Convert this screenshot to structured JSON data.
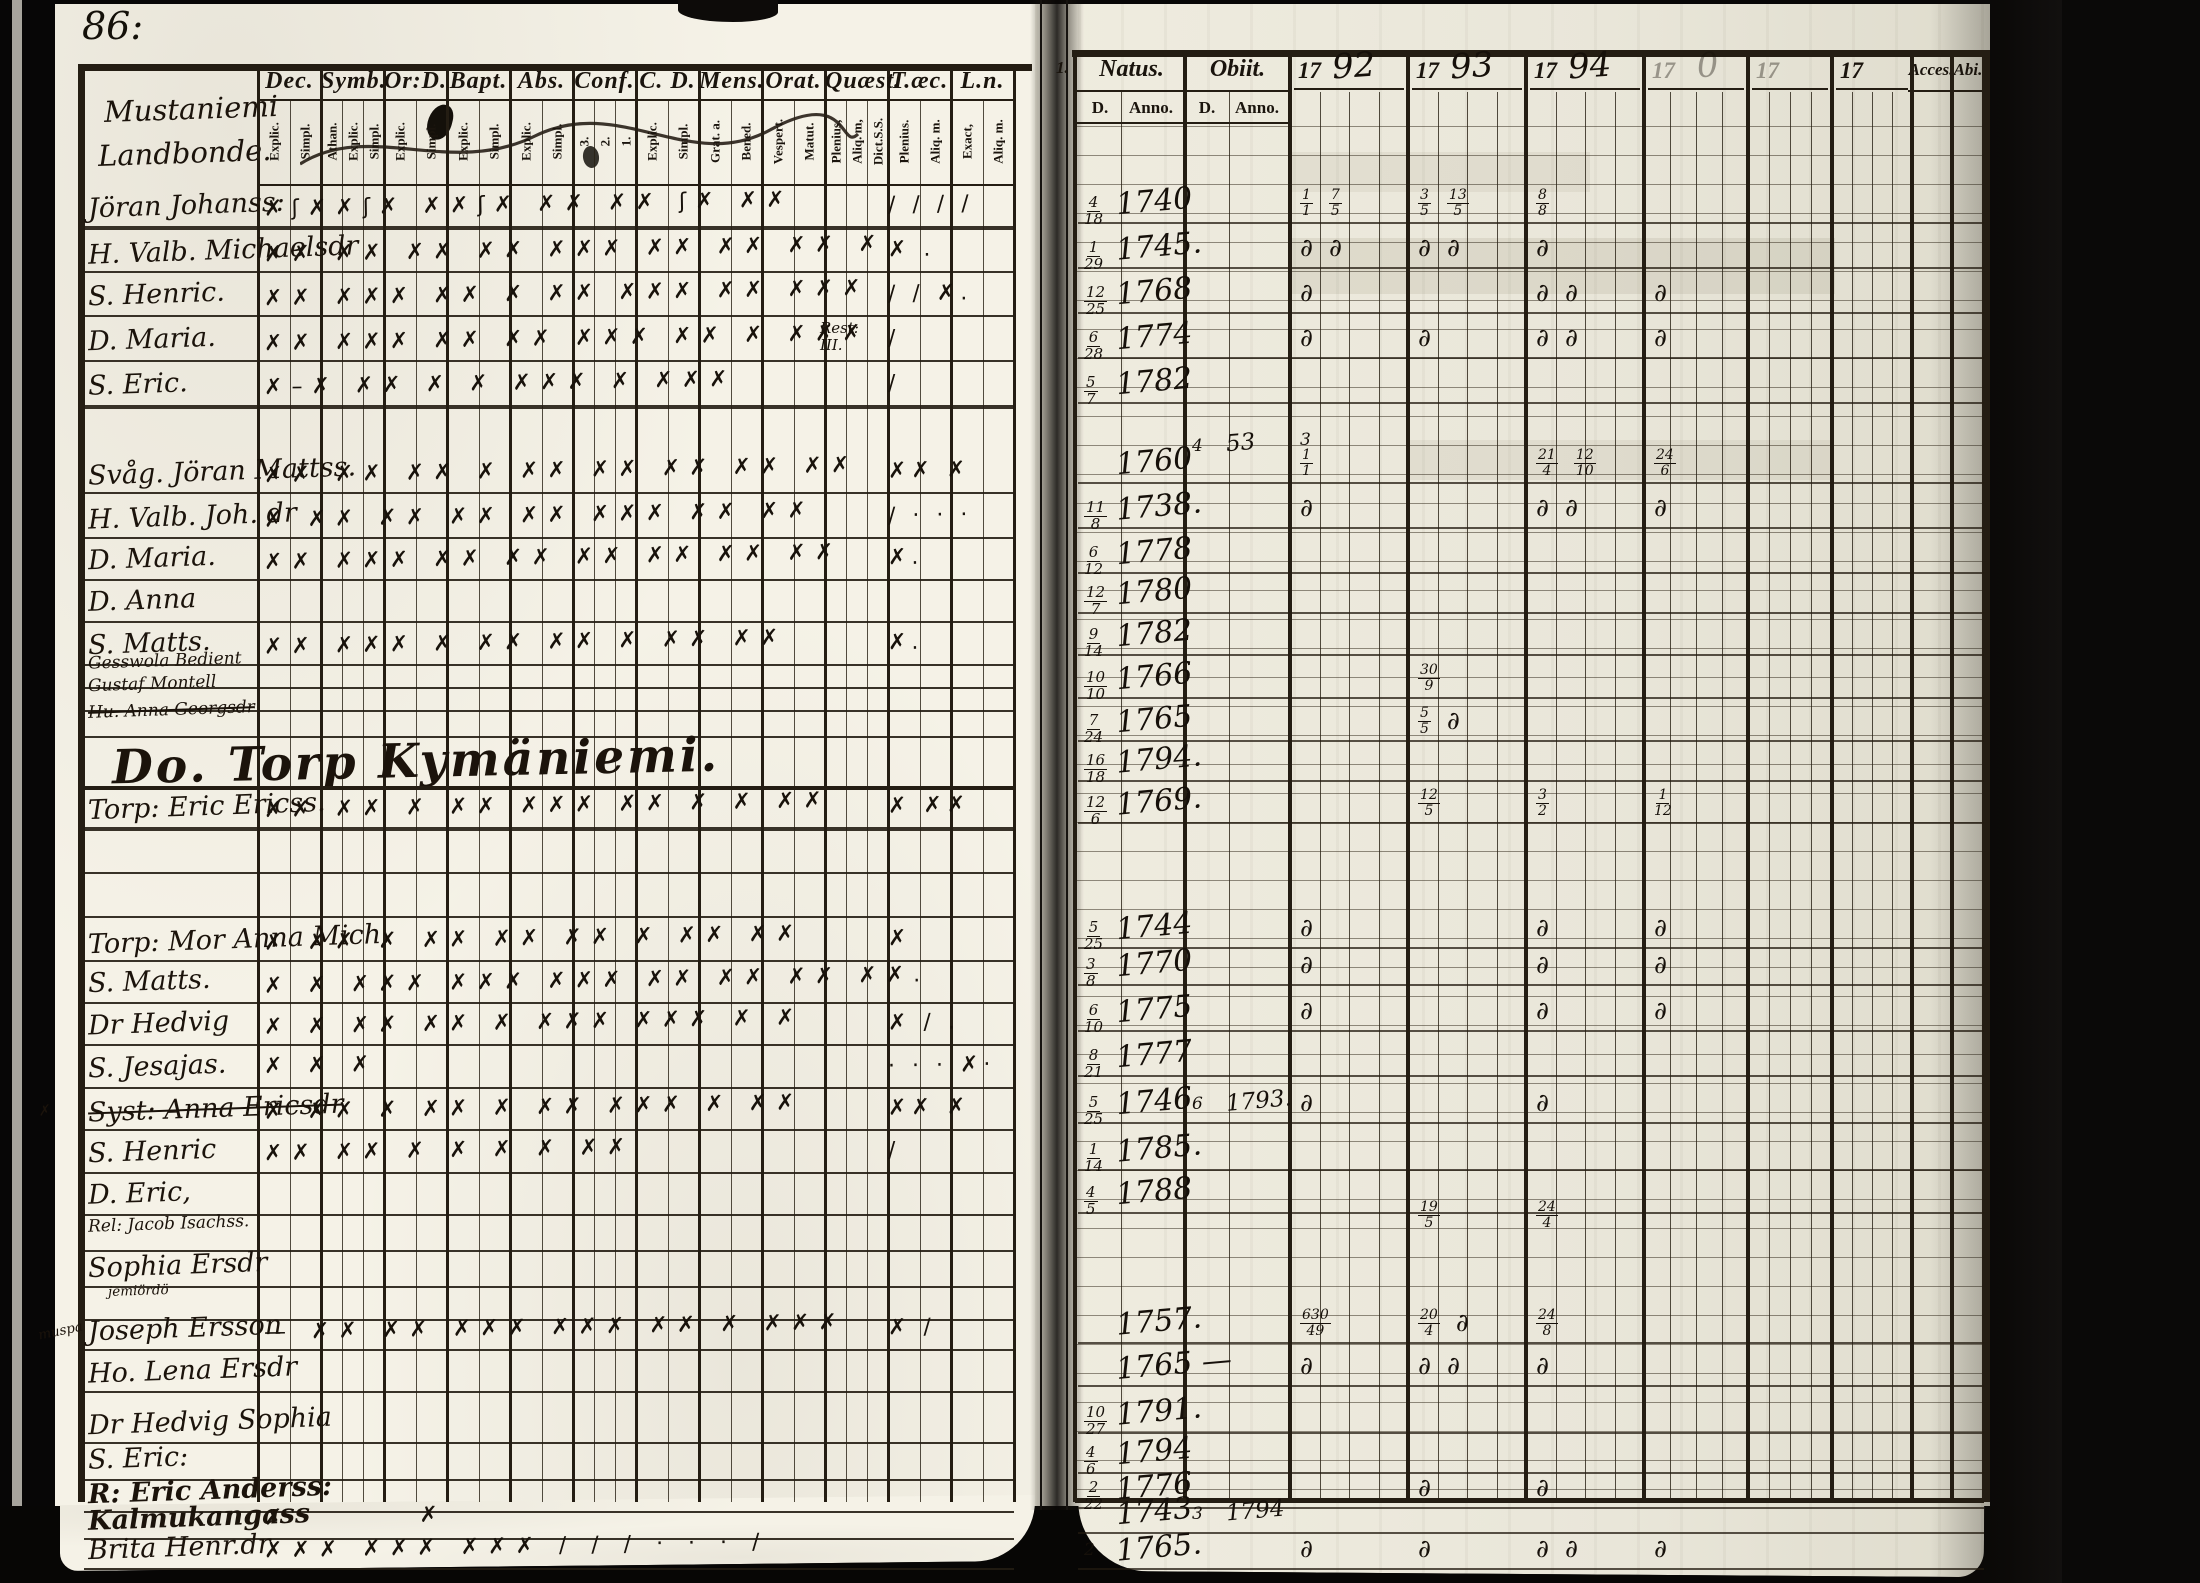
{
  "document": {
    "page_number": "86:"
  },
  "colors": {
    "paper_left": "#f5f2e7",
    "paper_right": "#edeade",
    "ink": "#1b130b",
    "rule": "#241d13"
  },
  "left_page": {
    "heading_lines": [
      "Mustaniemi",
      "Landbonde."
    ],
    "section_heading": "Do. Torp Kymäniemi.",
    "columns": [
      {
        "label": "Dec.",
        "subs": [
          "Explic.",
          "Simpl."
        ]
      },
      {
        "label": "Symb.",
        "subs": [
          "Athan.",
          "Explic.",
          "Simpl."
        ]
      },
      {
        "label": "Or:D.",
        "subs": [
          "Explic.",
          "Simpl."
        ]
      },
      {
        "label": "Bapt.",
        "subs": [
          "Explic.",
          "Simpl."
        ]
      },
      {
        "label": "Abs.",
        "subs": [
          "Explic.",
          "Simpl."
        ]
      },
      {
        "label": "Conf.",
        "subs": [
          "3.",
          "2.",
          "1."
        ]
      },
      {
        "label": "C. D.",
        "subs": [
          "Explic.",
          "Simpl."
        ]
      },
      {
        "label": "Mens.",
        "subs": [
          "Grat. a.",
          "Bened."
        ]
      },
      {
        "label": "Orat.",
        "subs": [
          "Vespert.",
          "Matut."
        ]
      },
      {
        "label": "Quæst.",
        "subs": [
          "Plenius,",
          "Aliq. m,",
          "Dict.S.S."
        ]
      },
      {
        "label": "T.æc.",
        "subs": [
          "Plenius.",
          "Aliq. m."
        ]
      },
      {
        "label": "L.n.",
        "subs": [
          "Exact,",
          "Aliq. m."
        ]
      }
    ],
    "rows": [
      {
        "y": 212,
        "name": "Jöran Johanss:",
        "marks": "✗ʃ✗✗ʃ✗ ✗✗ʃ✗ ✗✗ ✗✗ ʃ✗ ✗✗",
        "tail": "/ / / /",
        "thick": true
      },
      {
        "y": 257,
        "name": "H. Valb. Michaelsdr",
        "marks": "✗✗ ✗✗ ✗✗ ✗✗ ✗✗✗ ✗✗ ✗✗ ✗✗ ✗",
        "tail": "✗ ."
      },
      {
        "y": 301,
        "name": "S. Henric.",
        "marks": "✗✗ ✗✗✗ ✗✗ ✗ ✗✗ ✗✗✗ ✗✗ ✗✗✗",
        "tail": "/ / ✗."
      },
      {
        "y": 346,
        "name": "D. Maria.",
        "marks": "✗✗ ✗✗✗ ✗✗ ✗✗ ✗✗✗ ✗✗ ✗ ✗✗✗",
        "note": "Rest:\nIII.",
        "tail": "/"
      },
      {
        "y": 391,
        "name": "S. Eric.",
        "marks": "✗–✗ ✗✗ ✗ ✗ ✗✗✗ ✗ ✗✗✗",
        "tail": "/",
        "thick": true
      },
      {
        "y": 478,
        "name": "Svåg. Jöran Mattss.",
        "marks": "✗✗ ✗✗ ✗✗ ✗ ✗✗ ✗✗ ✗✗ ✗✗ ✗✗",
        "tail": "✗✗ ✗"
      },
      {
        "y": 523,
        "name": "H. Valb. Joh. dr",
        "marks": "✗ ✗✗ ✗✗ ✗✗ ✗✗ ✗✗✗ ✗✗ ✗✗",
        "tail": "/ · · ·"
      },
      {
        "y": 565,
        "name": "D. Maria.",
        "marks": "✗✗ ✗✗✗ ✗✗ ✗✗ ✗✗ ✗✗ ✗✗ ✗✗",
        "tail": "✗."
      },
      {
        "y": 607,
        "name": "D. Anna"
      },
      {
        "y": 650,
        "name": "S. Matts.",
        "marks": "✗✗ ✗✗✗ ✗ ✗✗ ✗✗ ✗ ✗✗ ✗✗",
        "tail": "✗."
      },
      {
        "y": 673,
        "name": "Gesswola Bedient",
        "small": 1
      },
      {
        "y": 696,
        "name": "Gustaf Montell",
        "small": 1
      },
      {
        "y": 722,
        "name": "Hu. Anna Georgsdr",
        "small": 1,
        "struck": true
      },
      {
        "y": 768,
        "heading": true
      },
      {
        "y": 813,
        "name": "Torp: Eric Ericss.",
        "marks": "✗✗ ✗✗ ✗ ✗✗ ✗✗✗ ✗✗ ✗ ✗ ✗✗",
        "tail": "✗ ✗✗",
        "thick": true
      },
      {
        "y": 858,
        "name": ""
      },
      {
        "y": 902,
        "name": ""
      },
      {
        "y": 946,
        "name": "Torp: Mor Anna Mich.",
        "marks": "✗ ✗✗ ✗ ✗✗ ✗✗ ✗✗ ✗ ✗✗ ✗✗",
        "tail": "✗"
      },
      {
        "y": 988,
        "name": "S. Matts.",
        "marks": "✗ ✗ ✗✗✗ ✗✗✗ ✗✗✗ ✗✗ ✗✗ ✗✗ ✗✗."
      },
      {
        "y": 1030,
        "name": "Dr Hedvig",
        "marks": "✗ ✗ ✗✗ ✗✗ ✗ ✗✗✗ ✗✗✗ ✗ ✗",
        "tail": "✗ / ."
      },
      {
        "y": 1073,
        "name": "S. Jesajas.",
        "marks": "✗ ✗ ✗",
        "tail": "· · · ✗·"
      },
      {
        "y": 1115,
        "name": "Syst: Anna Ericsdr",
        "struck": true,
        "margin": "✗",
        "marks": "✗ ✗✗ ✗ ✗✗ ✗ ✗✗ ✗✗✗ ✗ ✗✗",
        "tail": "✗✗ ✗"
      },
      {
        "y": 1158,
        "name": "S. Henric",
        "marks": "✗✗ ✗✗ ✗ ✗ ✗ ✗ ✗✗",
        "tail": "/"
      },
      {
        "y": 1200,
        "name": "D. Eric,"
      },
      {
        "y": 1236,
        "name": "Rel: Jacob Isachss.",
        "small": 1
      },
      {
        "y": 1272,
        "name": "Sophia Ersdr"
      },
      {
        "y": 1305,
        "name": "jemiördö",
        "small": 2,
        "x": 108
      },
      {
        "y": 1335,
        "name": "Joseph Ersson",
        "marks": "— ✗✗ ✗✗ ✗✗✗ ✗✗✗ ✗✗ ✗ ✗✗✗",
        "tail": "✗ /",
        "margin": "muspa"
      },
      {
        "y": 1377,
        "name": "Ho. Lena Ersdr"
      },
      {
        "y": 1428,
        "name": "Dr Hedvig Sophia"
      },
      {
        "y": 1465,
        "name": "S. Eric:"
      },
      {
        "y": 1497,
        "name": "R: Eric Anderss:",
        "bold": true
      },
      {
        "y": 1524,
        "name": "Kalmukangass",
        "bold": true,
        "marks": "✗        ✗"
      },
      {
        "y": 1554,
        "name": "Brita Henr.dr",
        "marks": "✗✗✗ ✗✗✗ ✗✗✗ / / / · · · /"
      }
    ]
  },
  "right_page": {
    "row_prefix": "1.",
    "natus_label": "Natus.",
    "obiit_label": "Obiit.",
    "d_label": "D.",
    "anno_label": "Anno.",
    "acces_label": "Acces.",
    "abiit_label": "Abi.",
    "years": [
      {
        "t": "1792",
        "faint": false
      },
      {
        "t": "1793",
        "faint": false
      },
      {
        "t": "1794",
        "faint": false
      },
      {
        "t": "17 0",
        "faint": true
      },
      {
        "t": "17",
        "faint": true
      },
      {
        "t": "17",
        "faint": false
      }
    ],
    "rows": [
      {
        "y": 210,
        "d": "4/18",
        "anno": "1740",
        "c": [
          "1/1 7/5",
          "3/5 13/5",
          "8/8",
          "",
          "",
          ""
        ]
      },
      {
        "y": 255,
        "d": "1/29",
        "anno": "1745.",
        "c": [
          "d d",
          "d d",
          "d",
          "",
          "",
          ""
        ]
      },
      {
        "y": 300,
        "d": "12/25",
        "anno": "1768",
        "c": [
          "d",
          "",
          "d d",
          "d",
          "",
          ""
        ]
      },
      {
        "y": 345,
        "d": "6/28",
        "anno": "1774",
        "c": [
          "d",
          "d",
          "d d",
          "d",
          "",
          ""
        ]
      },
      {
        "y": 390,
        "d": "5/7",
        "anno": "1782",
        "c": [
          "",
          "",
          "",
          "",
          "",
          ""
        ]
      },
      {
        "y": 452,
        "od": "4",
        "oanno": "53",
        "c": [
          "3",
          "",
          "",
          "",
          "",
          ""
        ]
      },
      {
        "y": 470,
        "anno": "1760",
        "c": [
          "1/1",
          "",
          "21/4 12/10",
          "24/6",
          "",
          ""
        ]
      },
      {
        "y": 515,
        "d": "11/8",
        "anno": "1738.",
        "c": [
          "d",
          "",
          "d d",
          "d",
          "",
          ""
        ]
      },
      {
        "y": 560,
        "d": "6/12",
        "anno": "1778",
        "c": [
          "",
          "",
          "",
          "",
          "",
          ""
        ]
      },
      {
        "y": 600,
        "d": "12/7",
        "anno": "1780",
        "c": [
          "",
          "",
          "",
          "",
          "",
          ""
        ]
      },
      {
        "y": 642,
        "d": "9/14",
        "anno": "1782",
        "c": [
          "",
          "",
          "",
          "",
          "",
          ""
        ]
      },
      {
        "y": 685,
        "d": "10/10",
        "anno": "1766",
        "c": [
          "",
          "30/9",
          "",
          "",
          "",
          ""
        ]
      },
      {
        "y": 728,
        "d": "7/24",
        "anno": "1765",
        "c": [
          "",
          "5/5 d",
          "",
          "",
          "",
          ""
        ]
      },
      {
        "y": 768,
        "d": "16/18",
        "anno": "1794.",
        "c": [
          "",
          "",
          "",
          "",
          "",
          ""
        ]
      },
      {
        "y": 810,
        "d": "12/6",
        "anno": "1769.",
        "c": [
          "",
          "12/5",
          "3/2",
          "1/12",
          "",
          ""
        ]
      },
      {
        "y": 935,
        "d": "5/25",
        "anno": "1744",
        "c": [
          "d",
          "",
          "d",
          "d",
          "",
          ""
        ]
      },
      {
        "y": 972,
        "d": "3/8",
        "anno": "1770",
        "c": [
          "d",
          "",
          "d",
          "d",
          "",
          ""
        ]
      },
      {
        "y": 1018,
        "d": "6/10",
        "anno": "1775",
        "c": [
          "d",
          "",
          "d",
          "d",
          "",
          ""
        ]
      },
      {
        "y": 1063,
        "d": "8/21",
        "anno": "1777",
        "c": [
          "",
          "",
          "",
          "",
          "",
          ""
        ]
      },
      {
        "y": 1110,
        "d": "5/25",
        "anno": "1746",
        "od": "6",
        "oanno": "1793.",
        "c": [
          "d",
          "",
          "d",
          "",
          "",
          ""
        ]
      },
      {
        "y": 1157,
        "d": "1/14",
        "anno": "1785.",
        "c": [
          "",
          "",
          "",
          "",
          "",
          ""
        ]
      },
      {
        "y": 1200,
        "d": "4/5",
        "anno": "1788",
        "c": [
          "",
          "",
          "",
          "",
          "",
          ""
        ]
      },
      {
        "y": 1222,
        "c": [
          "",
          "19/5",
          "24/4",
          "",
          "",
          ""
        ]
      },
      {
        "y": 1330,
        "anno": "1757.",
        "c": [
          "630/49",
          "20/4 d",
          "24/8",
          "",
          "",
          ""
        ]
      },
      {
        "y": 1373,
        "anno": "1765 —",
        "c": [
          "d",
          "d d",
          "d",
          "",
          "",
          ""
        ]
      },
      {
        "y": 1420,
        "d": "10/27",
        "anno": "1791.",
        "c": [
          "",
          "",
          "",
          "",
          "",
          ""
        ]
      },
      {
        "y": 1460,
        "d": "4/6",
        "anno": "1794",
        "c": [
          "",
          "",
          "",
          "",
          "",
          ""
        ]
      },
      {
        "y": 1495,
        "d": "2/22",
        "anno": "1776",
        "c": [
          "",
          "d",
          "d",
          "",
          "",
          ""
        ]
      },
      {
        "y": 1520,
        "anno": "1743",
        "od": "3",
        "oanno": "1794",
        "c": [
          "",
          "",
          "",
          "",
          "",
          ""
        ]
      },
      {
        "y": 1556,
        "d": "2",
        "anno": "1765.",
        "c": [
          "d",
          "d",
          "d d",
          "d",
          "",
          ""
        ]
      }
    ]
  }
}
